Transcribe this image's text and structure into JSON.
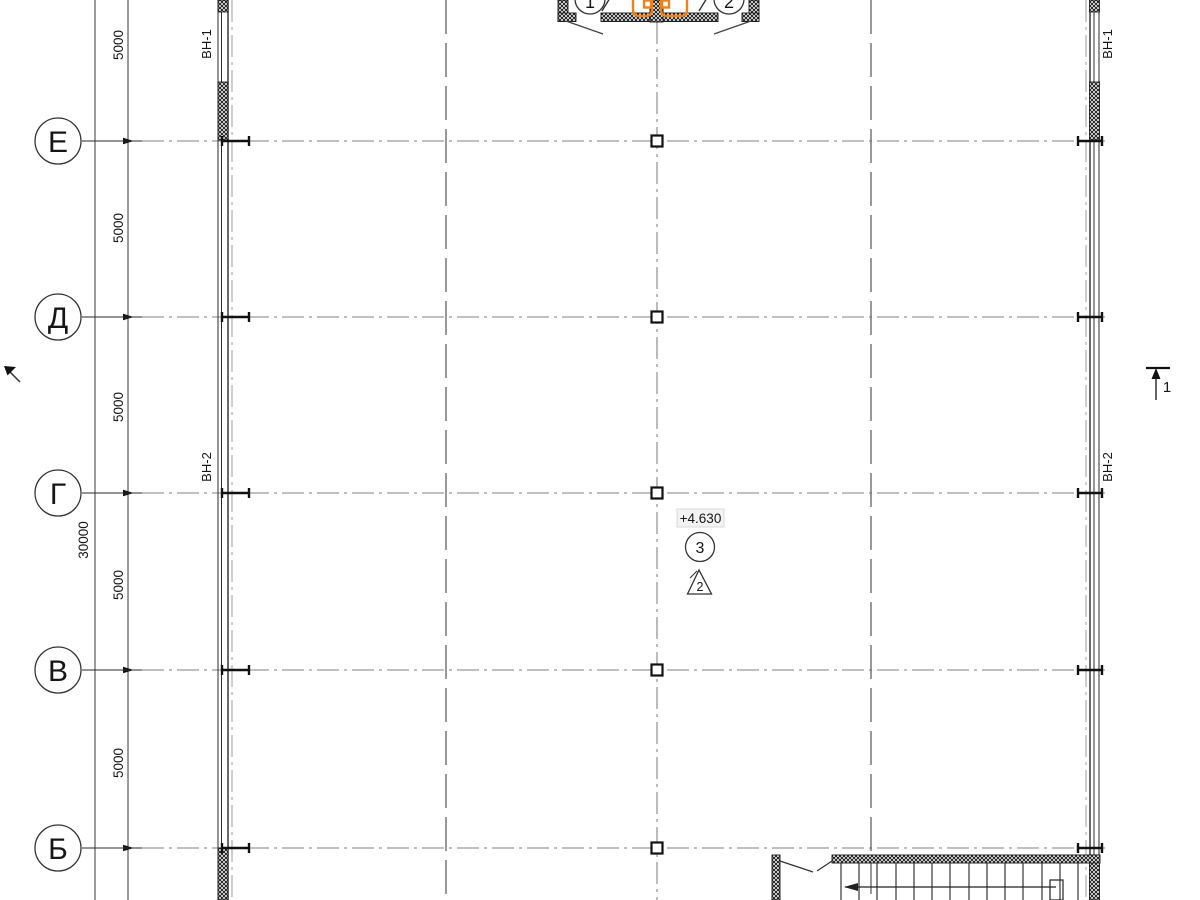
{
  "axes": {
    "row_labels": [
      "Е",
      "Д",
      "Г",
      "В",
      "Б"
    ]
  },
  "dims": {
    "span_labels": [
      "5000",
      "5000",
      "5000",
      "5000",
      "5000"
    ],
    "total_label": "30000"
  },
  "window_marks": {
    "left_top": "ВН-1",
    "left_mid": "ВН-2",
    "right_top": "ВН-1",
    "right_mid": "ВН-2"
  },
  "callouts": {
    "detail_left": "1",
    "detail_right": "2",
    "node_circle": "3",
    "node_triangle": "2",
    "elevation": "+4.630",
    "section_left": "1",
    "section_right": "1"
  },
  "colors": {
    "accent": "#F08019",
    "axis_line": "#9b9b9b",
    "ink": "#1a1a1a"
  }
}
